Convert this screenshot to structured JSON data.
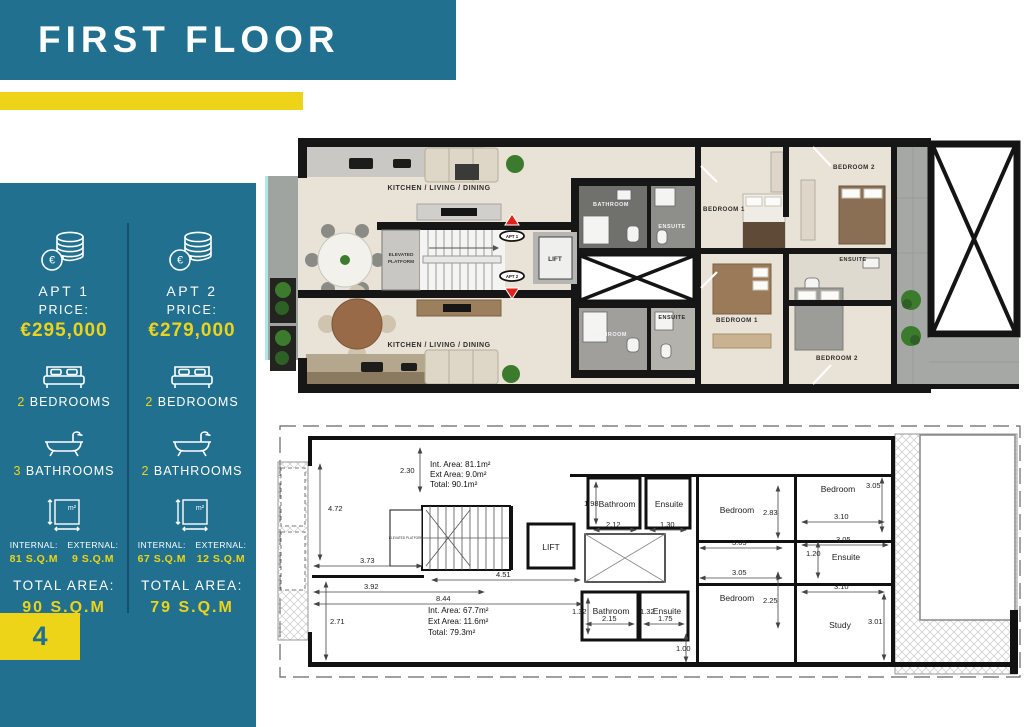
{
  "header": {
    "title": "FIRST FLOOR"
  },
  "footer": {
    "page_number": "4"
  },
  "colors": {
    "teal": "#21708f",
    "yellow": "#edd418",
    "red_arrow": "#e3201b"
  },
  "icons": {
    "euro": "€",
    "sqm": "m²"
  },
  "sidebar": {
    "apartments": [
      {
        "name": "APT 1",
        "price_label": "PRICE:",
        "price": "€295,000",
        "bedrooms_count": "2",
        "bedrooms_label": "BEDROOMS",
        "bathrooms_count": "3",
        "bathrooms_label": "BATHROOMS",
        "internal_label": "INTERNAL:",
        "internal_value": "81 S.Q.M",
        "external_label": "EXTERNAL:",
        "external_value": "9 S.Q.M",
        "total_label": "TOTAL AREA:",
        "total_value": "90 S.Q.M"
      },
      {
        "name": "APT 2",
        "price_label": "PRICE:",
        "price": "€279,000",
        "bedrooms_count": "2",
        "bedrooms_label": "BEDROOMS",
        "bathrooms_count": "2",
        "bathrooms_label": "BATHROOMS",
        "internal_label": "INTERNAL:",
        "internal_value": "67 S.Q.M",
        "external_label": "EXTERNAL:",
        "external_value": "12 S.Q.M",
        "total_label": "TOTAL AREA:",
        "total_value": "79 S.Q.M"
      }
    ]
  },
  "render_plan": {
    "kitchen_top": "KITCHEN / LIVING / DINING",
    "kitchen_bottom": "KITCHEN / LIVING / DINING",
    "elevated_l1": "ELEVATED",
    "elevated_l2": "PLATFORM",
    "apt1_tag": "APT 1",
    "apt2_tag": "APT 2",
    "lift": "LIFT",
    "bathroom_top": "BATHROOM",
    "ensuite_top": "ENSUITE",
    "bedroom1_top": "BEDROOM 1",
    "bedroom2_top": "BEDROOM 2",
    "ensuite_mid": "ENSUITE",
    "bathroom_bottom": "BATHROOM",
    "ensuite_bottom": "ENSUITE",
    "bedroom1_bottom": "BEDROOM 1",
    "bedroom2_bottom": "BEDROOM 2"
  },
  "tech_plan": {
    "apt1_area": {
      "int": "Int. Area: 81.1m²",
      "ext": "Ext Area: 9.0m²",
      "total": "Total: 90.1m²"
    },
    "apt2_area": {
      "int": "Int. Area: 67.7m²",
      "ext": "Ext Area: 11.6m²",
      "total": "Total: 79.3m²"
    },
    "rooms": {
      "lift": "LIFT",
      "elevated_platform": "ELEVATED PLATFORM",
      "bathroom_top": "Bathroom",
      "ensuite_top": "Ensuite",
      "bedroom_mid_top": "Bedroom",
      "bedroom_top_right": "Bedroom",
      "ensuite_mid": "Ensuite",
      "bedroom_mid_bottom": "Bedroom",
      "study": "Study",
      "bathroom_bottom": "Bathroom",
      "ensuite_bottom": "Ensuite"
    },
    "dims": {
      "d472": "4.72",
      "d230": "2.30",
      "d373": "3.73",
      "d392": "3.92",
      "d844": "8.44",
      "d451": "4.51",
      "d271": "2.71",
      "d198": "1.98",
      "d212": "2.12",
      "d130": "1.30",
      "d283": "2.83",
      "d305a": "3.05",
      "d305b": "3.05",
      "d305c": "3.05",
      "d305d": "3.05",
      "d310a": "3.10",
      "d310b": "3.10",
      "d120": "1.20",
      "d225": "2.25",
      "d301": "3.01",
      "d132a": "1.32",
      "d215": "2.15",
      "d132b": "1.32",
      "d175": "1.75",
      "d100": "1.00"
    }
  }
}
